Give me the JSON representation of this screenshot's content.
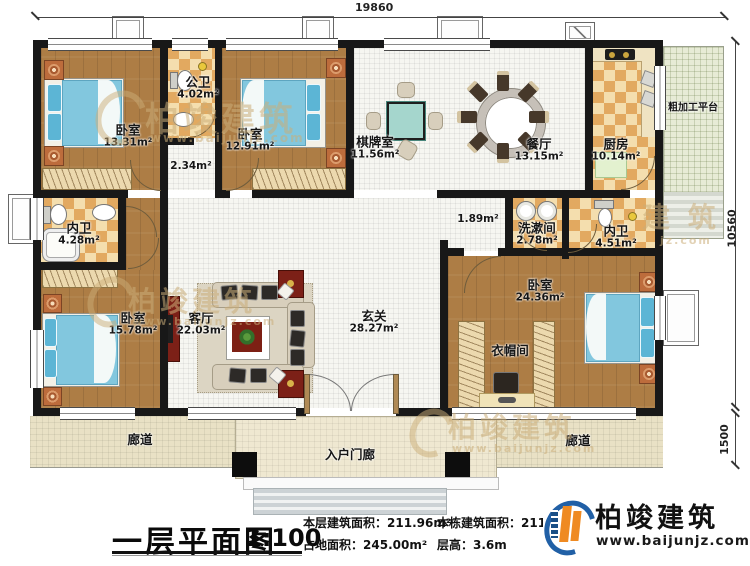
{
  "plan": {
    "name": "一层平面图"
  },
  "dimensions": {
    "top_width": "19860",
    "right_height": "10560",
    "corridor_depth": "1500"
  },
  "rooms": {
    "bedroom_tl": {
      "name": "卧室",
      "area": "13.31m²"
    },
    "public_bath": {
      "name": "公卫",
      "area": "4.02m²"
    },
    "hall": {
      "area": "2.34m²"
    },
    "bedroom_tm": {
      "name": "卧室",
      "area": "12.91m²"
    },
    "chess_room": {
      "name": "棋牌室",
      "area": "11.56m²"
    },
    "dining": {
      "name": "餐厅",
      "area": "13.15m²"
    },
    "kitchen": {
      "name": "厨房",
      "area": "10.14m²"
    },
    "platform": {
      "name": "粗加工平台"
    },
    "bath_left": {
      "name": "内卫",
      "area": "4.28m²"
    },
    "washroom": {
      "name": "洗漱间",
      "area": "2.78m²"
    },
    "bath_right": {
      "name": "内卫",
      "area": "4.51m²"
    },
    "passage": {
      "area": "1.89m²"
    },
    "bedroom_bl": {
      "name": "卧室",
      "area": "15.78m²"
    },
    "living_room": {
      "name": "客厅",
      "area": "22.03m²"
    },
    "foyer": {
      "name": "玄关",
      "area": "28.27m²"
    },
    "master_bedroom": {
      "name": "卧室",
      "area": "24.36m²"
    },
    "cloakroom": {
      "name": "衣帽间"
    },
    "corridor_left": {
      "name": "廊道"
    },
    "corridor_right": {
      "name": "廊道"
    },
    "entry_porch": {
      "name": "入户门廊"
    }
  },
  "title_block": {
    "title": "一层平面图",
    "scale": "1:100",
    "floor_area_label": "本层建筑面积：",
    "floor_area_value": "211.96m²",
    "land_area_label": "占地面积：",
    "land_area_value": "245.00m²",
    "building_area_label": "本栋建筑面积：",
    "building_area_value": "211.9",
    "storey_height_label": "层高：",
    "storey_height_value": "3.6m"
  },
  "brand": {
    "name": "柏竣建筑",
    "website": "www.baijunjz.com"
  },
  "watermark": {
    "text": "柏竣建筑",
    "subtext": "www.baijunjz.com",
    "partial_text": "建 筑",
    "partial_subtext": "jz.com"
  }
}
